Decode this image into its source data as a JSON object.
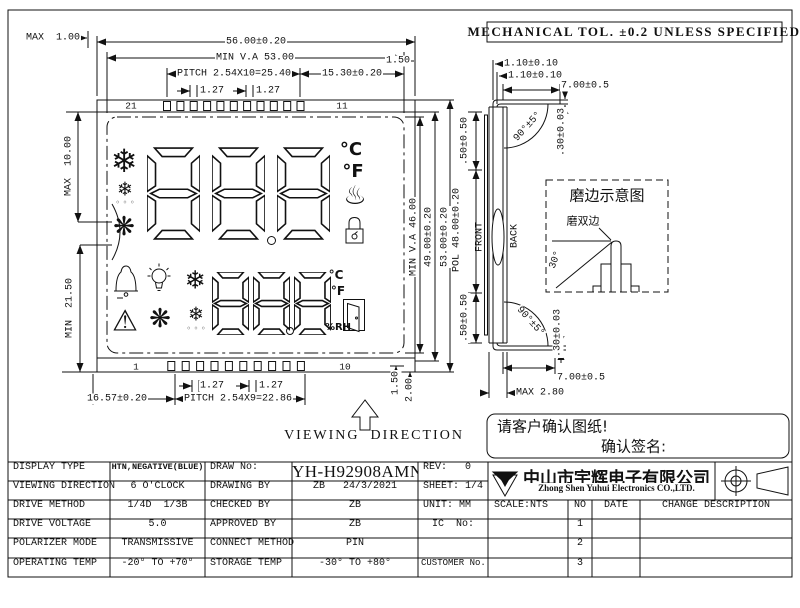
{
  "tol_note": "MECHANICAL TOL. ±0.2 UNLESS SPECIFIED",
  "front": {
    "dim_max_top": "MAX  1.00",
    "dim_width": "56.00±0.20",
    "dim_va_w": "MIN V.A 53.00",
    "dim_pitch_top": "PITCH 2.54X10=25.40",
    "dim_right_off": "15.30±0.20",
    "dim_t127_a": "1.27",
    "dim_t127_b": "1.27",
    "dim_150_top": "1.50",
    "pin_top_left": "21",
    "pin_top_right": "11",
    "pin_bot_left": "1",
    "pin_bot_right": "10",
    "dim_max10": "MAX  10.00",
    "dim_min215": "MIN  21.50",
    "dim_va_h": "MIN V.A 46.00",
    "dim_h49": "49.00±0.20",
    "dim_h53": "53.00±0.20",
    "dim_150_bot": "1.50",
    "dim_200": "2.00",
    "dim_b127_a": "1.27",
    "dim_b127_b": "1.27",
    "dim_1657": "16.57±0.20",
    "dim_pitch_bot": "PITCH 2.54X9=22.86",
    "viewing": "VIEWING  DIRECTION",
    "lcd": {
      "c_big": "°C",
      "f_big": "°F",
      "c_small": "°C",
      "f_small": "°F",
      "rh": "%RH",
      "snow1": "❄",
      "snow2": "❄",
      "snow3": "❄",
      "snow4": "❄",
      "fan1": "❋",
      "fan2": "❋",
      "warn": "⚠",
      "steam": "♨",
      "drips1": "◦ ◦ ◦",
      "drips2": "◦ ◦ ◦"
    }
  },
  "side": {
    "dim_110a": "1.10±0.10",
    "dim_110b": "1.10±0.10",
    "dim_700_top": "7.00±0.5",
    "dim_030_top": ".30±0.03",
    "dim_angle_top": "90°±5°",
    "dim_050_top": ".50±0.50",
    "dim_pol": "POL 48.00±0.20",
    "dim_050_bot": ".50±0.50",
    "front_label": "FRONT",
    "back_label": "BACK",
    "dim_angle_bot": "90°±5°",
    "dim_030_bot": ".30±0.03",
    "dim_700_bot": "7.00±0.5",
    "dim_max28": "MAX 2.80"
  },
  "grind": {
    "title": "磨边示意图",
    "label": "磨双边",
    "angle": "30°"
  },
  "confirm": {
    "line1": "请客户确认图纸!",
    "line2": "确认签名:"
  },
  "table": {
    "rows": [
      {
        "c1": "DISPLAY TYPE",
        "c2": "HTN,NEGATIVE(BLUE)",
        "c3": "DRAW No:",
        "c4": "YH-H92908AMN",
        "c5": "REV:   0"
      },
      {
        "c1": "VIEWING DIRECTION",
        "c2": "6 O'CLOCK",
        "c3": "DRAWING BY",
        "c4": "ZB   24/3/2021",
        "c5": "SHEET: 1/4"
      },
      {
        "c1": "DRIVE METHOD",
        "c2": "1/4D  1/3B",
        "c3": "CHECKED BY",
        "c4": "ZB",
        "c5": "UNIT: MM"
      },
      {
        "c1": "DRIVE VOLTAGE",
        "c2": "5.0",
        "c3": "APPROVED BY",
        "c4": "ZB",
        "c5": "IC  No:"
      },
      {
        "c1": "POLARIZER MODE",
        "c2": "TRANSMISSIVE",
        "c3": "CONNECT METHOD",
        "c4": "PIN",
        "c5": ""
      },
      {
        "c1": "OPERATING TEMP",
        "c2": "-20° TO +70°",
        "c3": "STORAGE TEMP",
        "c4": "-30° TO +80°",
        "c5": "CUSTOMER No."
      }
    ],
    "company_cn": "中山市宇辉电子有限公司",
    "company_en": "Zhong Shen Yuhui Electronics CO.,LTD.",
    "scale": "SCALE:NTS",
    "no_h": "NO",
    "date_h": "DATE",
    "change_h": "CHANGE DESCRIPTION",
    "no_rows": [
      "1",
      "2",
      "3"
    ]
  }
}
